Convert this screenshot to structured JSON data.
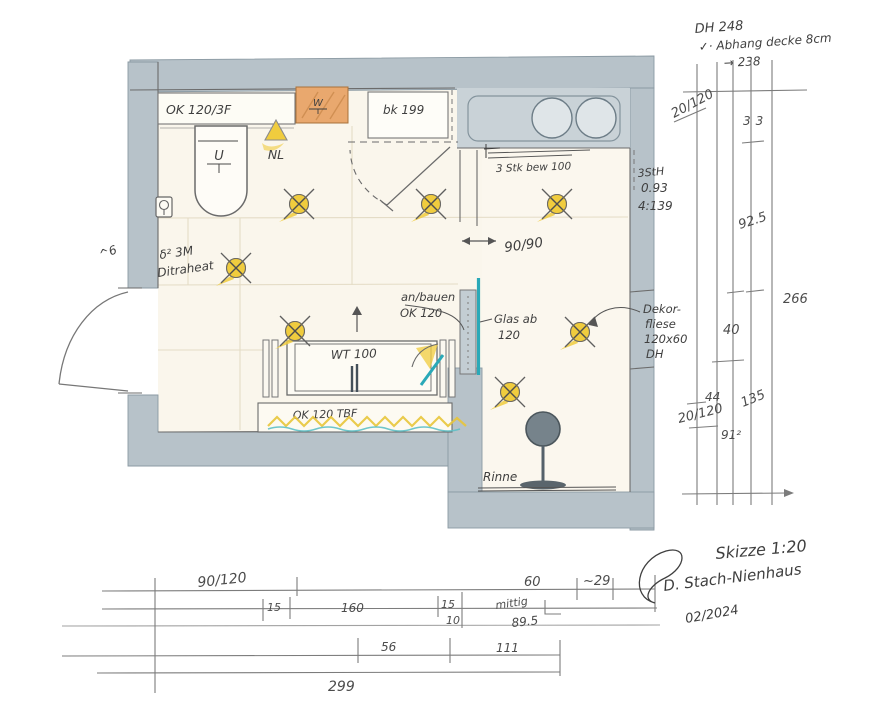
{
  "title_block": {
    "scale": "Skizze 1:20",
    "signature": "D. Stach-Nienhaus",
    "date": "02/2024"
  },
  "ceiling_note": {
    "line1": "DH 248",
    "line2": "✓· Abhang decke 8cm",
    "line3": "→ 238"
  },
  "fixtures": {
    "counter_label": "OK 120/3F",
    "washer_mark": "W",
    "cabinet_label": "bk 199",
    "wc_mark": "U",
    "nl_label": "NL",
    "window_note": "3 Stk bew 100",
    "stair_note_1": "3StH",
    "stair_note_2": "0.93",
    "stair_note_3": "4:139",
    "clearance_label": "90/90",
    "anbau_note_1": "an/bauen",
    "anbau_note_2": "OK 120",
    "glass_note_1": "Glas ab",
    "glass_note_2": "120",
    "vanity_label": "WT 100",
    "bench_label": "OK 120 TBF",
    "heating_note_1": "δ² 3M",
    "heating_note_2": "Ditraheat",
    "door_note": "^6",
    "tile_note_1": "Dekor-",
    "tile_note_2": "fliese",
    "tile_note_3": "120x60",
    "tile_note_4": "DH",
    "drain_label": "Rinne"
  },
  "dims_right": {
    "labels": [
      "20/120",
      "33",
      "92.5",
      "266",
      "40",
      "44",
      "135",
      "20/120",
      "91²"
    ]
  },
  "dims_bottom": {
    "labels": [
      "90/120",
      "60",
      "~29",
      "15",
      "160",
      "15",
      "10",
      "mittig",
      "89.5",
      "56",
      "111",
      "299"
    ]
  },
  "colors": {
    "wall": "#b7c2c9",
    "floor": "#faf6ec",
    "accent_orange": "#e9a86e",
    "accent_yellow": "#f0cc3e",
    "accent_teal": "#2aa9b8",
    "pencil": "#6b6b6b",
    "ink": "#3f3f3f"
  }
}
